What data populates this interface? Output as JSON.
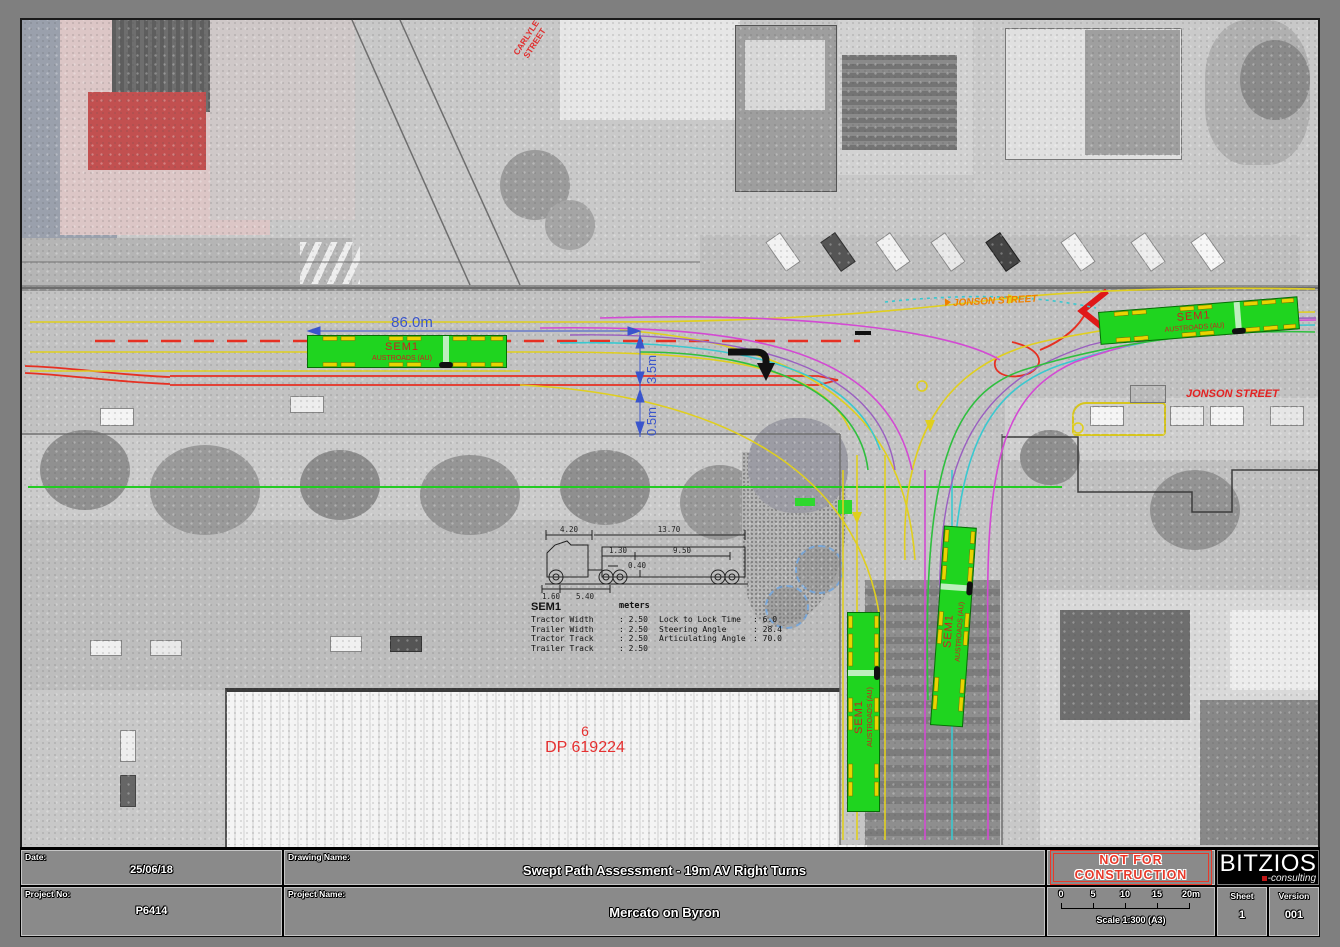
{
  "drawing": {
    "street_labels": {
      "carlyle_line1": "CARLYLE",
      "carlyle_line2": "STREET",
      "jonson_top": "JONSON STREET",
      "jonson_right": "JONSON STREET"
    },
    "lot": {
      "number": "6",
      "plan": "DP 619224"
    },
    "dims": {
      "length": "86.0m",
      "lane": "3.5m",
      "offset": "0.5m"
    },
    "truck_label": {
      "line1": "SEM1",
      "line2": "AUSTROADS (AU)"
    },
    "spec": {
      "name": "SEM1",
      "units": "meters",
      "d_tractor": "4.20",
      "d_trailer": "13.70",
      "d_kingpin": "1.30",
      "d_axle": "9.50",
      "d_gap": "0.40",
      "d_overhang": "1.60",
      "d_wheelbase": "5.40",
      "rows_left": [
        {
          "label": "Tractor Width",
          "value": ": 2.50"
        },
        {
          "label": "Trailer Width",
          "value": ": 2.50"
        },
        {
          "label": "Tractor Track",
          "value": ": 2.50"
        },
        {
          "label": "Trailer Track",
          "value": ": 2.50"
        }
      ],
      "rows_right": [
        {
          "label": "Lock to Lock Time",
          "value": ": 6.0"
        },
        {
          "label": "Steering Angle",
          "value": ": 28.4"
        },
        {
          "label": "Articulating Angle",
          "value": ": 70.0"
        }
      ]
    }
  },
  "title_block": {
    "date_label": "Date:",
    "date_value": "25/06/18",
    "project_no_label": "Project No:",
    "project_no_value": "P6414",
    "drawing_name_label": "Drawing Name:",
    "drawing_name_value": "Swept Path Assessment - 19m AV Right Turns",
    "project_name_label": "Project Name:",
    "project_name_value": "Mercato on Byron",
    "stamp_line1": "NOT FOR",
    "stamp_line2": "CONSTRUCTION",
    "logo_text": "BITZIOS",
    "logo_sub": "-consulting",
    "scale_ticks": [
      "0",
      "5",
      "10",
      "15",
      "20m"
    ],
    "scale_text": "Scale 1:300 (A3)",
    "sheet_label": "Sheet",
    "sheet_value": "1",
    "version_label": "Version",
    "version_value": "001"
  },
  "colors": {
    "truck_fill": "#1fd41f",
    "path_magenta": "#d34ad3",
    "path_cyan": "#3ac8cf",
    "path_yellow": "#e0cf1e",
    "path_green": "#2fbf3f",
    "path_purple": "#9a5fc0",
    "marking_red": "#e63022",
    "dim_blue": "#3a55cc",
    "stamp_red": "#e8392a"
  }
}
